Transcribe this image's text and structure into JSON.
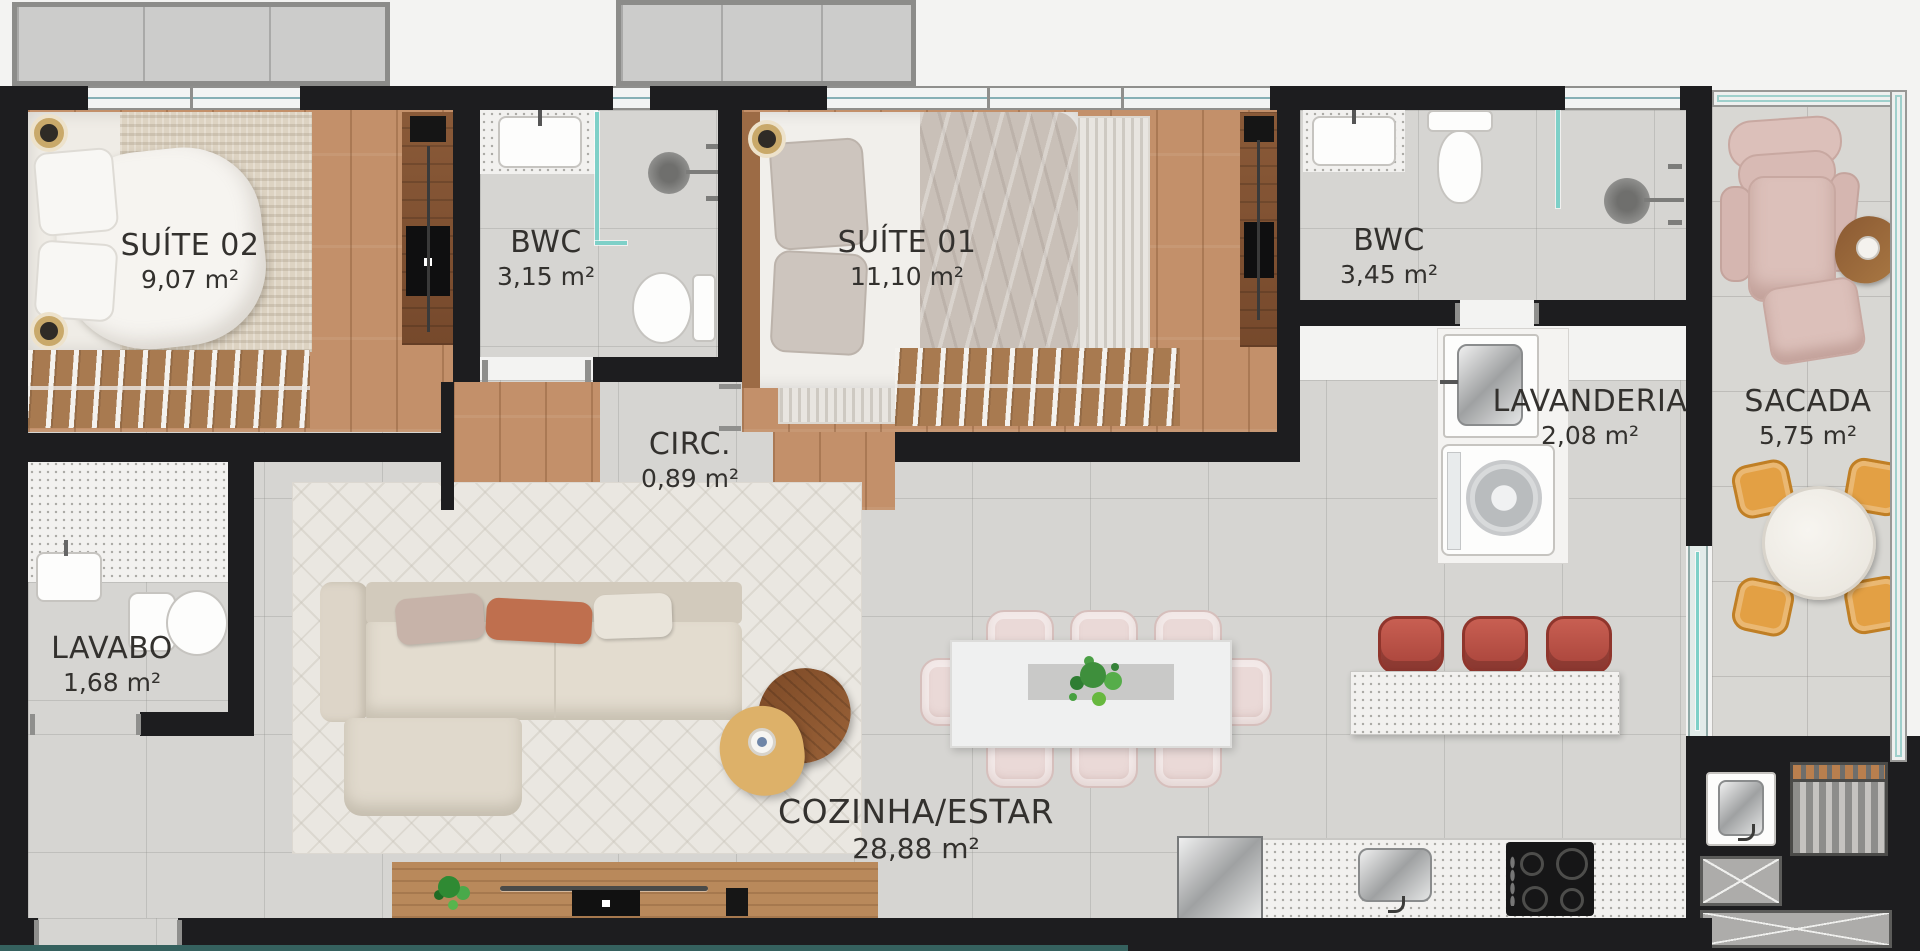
{
  "plan": {
    "title": "apartment-floor-plan",
    "rooms": [
      {
        "key": "suite02",
        "name": "SUÍTE 02",
        "area": "9,07 m²"
      },
      {
        "key": "bwc_suite02",
        "name": "BWC",
        "area": "3,15 m²"
      },
      {
        "key": "suite01",
        "name": "SUÍTE 01",
        "area": "11,10 m²"
      },
      {
        "key": "bwc_suite01",
        "name": "BWC",
        "area": "3,45 m²"
      },
      {
        "key": "circulacao",
        "name": "CIRC.",
        "area": "0,89 m²"
      },
      {
        "key": "lavabo",
        "name": "LAVABO",
        "area": "1,68 m²"
      },
      {
        "key": "lavanderia",
        "name": "LAVANDERIA",
        "area": "2,08 m²"
      },
      {
        "key": "sacada",
        "name": "SACADA",
        "area": "5,75 m²"
      },
      {
        "key": "cozinha_estar",
        "name": "COZINHA/ESTAR",
        "area": "28,88 m²"
      }
    ],
    "colors": {
      "wall": "#1d1d1f",
      "wood_floor": "#c3906a",
      "tile_floor": "#d6d5d2",
      "glass": "#7ed0c8",
      "balcony_chair": "#e3a044",
      "bar_stool": "#b85043",
      "dining_chair": "#ead9d7",
      "label_text": "#33312e"
    }
  }
}
